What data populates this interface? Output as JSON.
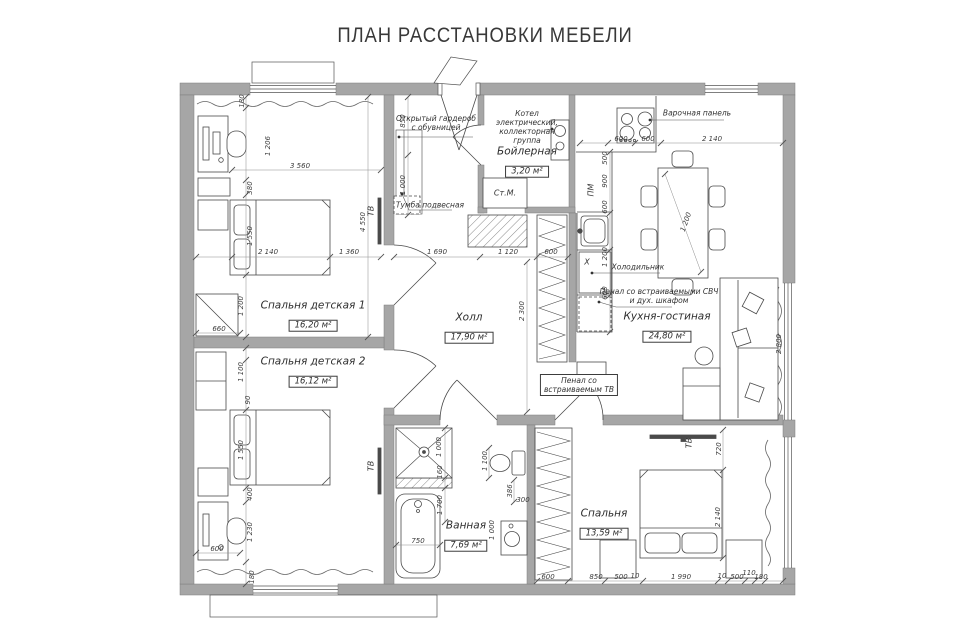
{
  "title": "ПЛАН РАССТАНОВКИ МЕБЕЛИ",
  "colors": {
    "wall_fill": "#a6a6a6",
    "wall_edge": "#7d7d7d",
    "line": "#4a4a4a",
    "dim_line": "#777777",
    "text": "#333333",
    "background": "#ffffff"
  },
  "rooms": [
    {
      "name": "Спальня детская 1",
      "area": "16,20 м²",
      "x": 313,
      "y": 316
    },
    {
      "name": "Спальня детская 2",
      "area": "16,12 м²",
      "x": 313,
      "y": 372
    },
    {
      "name": "Холл",
      "area": "17,90 м²",
      "x": 469,
      "y": 328
    },
    {
      "name": "Кухня-гостиная",
      "area": "24,80 м²",
      "x": 667,
      "y": 327
    },
    {
      "name": "Бойлерная",
      "area": "3,20 м²",
      "x": 527,
      "y": 162
    },
    {
      "name": "Ванная",
      "area": "7,69 м²",
      "x": 466,
      "y": 536
    },
    {
      "name": "Спальня",
      "area": "13,59 м²",
      "x": 604,
      "y": 524
    }
  ],
  "annotations": [
    {
      "text": "Открытый гардероб\nс обувницей",
      "x": 436,
      "y": 123
    },
    {
      "text": "Тумба подвесная",
      "x": 430,
      "y": 205
    },
    {
      "text": "Котел\nэлектрический,\nколлекторная\nгруппа",
      "x": 527,
      "y": 127
    },
    {
      "text": "Варочная панель",
      "x": 697,
      "y": 113
    },
    {
      "text": "Холодильник",
      "x": 638,
      "y": 267
    },
    {
      "text": "Пенал со встраиваемыми СВЧ\nи дух. шкафом",
      "x": 659,
      "y": 296
    },
    {
      "text": "Пенал со\nвстраиваемым ТВ",
      "x": 579,
      "y": 385,
      "boxed": true
    }
  ],
  "small_labels": [
    {
      "text": "ТВ",
      "x": 371,
      "y": 211,
      "rot": true
    },
    {
      "text": "ТВ",
      "x": 371,
      "y": 466,
      "rot": true
    },
    {
      "text": "ТВ",
      "x": 689,
      "y": 443,
      "rot": true
    },
    {
      "text": "ПМ",
      "x": 591,
      "y": 190,
      "rot": true
    },
    {
      "text": "X",
      "x": 587,
      "y": 262
    },
    {
      "text": "Ст.М.",
      "x": 505,
      "y": 193
    }
  ],
  "dimensions": [
    {
      "text": "180",
      "x": 242,
      "y": 101,
      "rot": true
    },
    {
      "text": "1 206",
      "x": 268,
      "y": 146,
      "rot": true
    },
    {
      "text": "380",
      "x": 250,
      "y": 188,
      "rot": true
    },
    {
      "text": "1 550",
      "x": 250,
      "y": 236,
      "rot": true
    },
    {
      "text": "3 560",
      "x": 300,
      "y": 166
    },
    {
      "text": "2 140",
      "x": 268,
      "y": 252
    },
    {
      "text": "1 360",
      "x": 349,
      "y": 252
    },
    {
      "text": "4 550",
      "x": 363,
      "y": 222,
      "rot": true
    },
    {
      "text": "660",
      "x": 219,
      "y": 329
    },
    {
      "text": "1 200",
      "x": 241,
      "y": 306,
      "rot": true
    },
    {
      "text": "1 100",
      "x": 241,
      "y": 372,
      "rot": true
    },
    {
      "text": "90",
      "x": 248,
      "y": 400,
      "rot": true
    },
    {
      "text": "1 550",
      "x": 241,
      "y": 450,
      "rot": true
    },
    {
      "text": "400",
      "x": 250,
      "y": 494,
      "rot": true
    },
    {
      "text": "1 230",
      "x": 250,
      "y": 532,
      "rot": true
    },
    {
      "text": "600",
      "x": 217,
      "y": 549
    },
    {
      "text": "180",
      "x": 252,
      "y": 577,
      "rot": true
    },
    {
      "text": "850",
      "x": 403,
      "y": 121,
      "rot": true
    },
    {
      "text": "1 000",
      "x": 403,
      "y": 185,
      "rot": true
    },
    {
      "text": "1 690",
      "x": 437,
      "y": 252
    },
    {
      "text": "1 120",
      "x": 508,
      "y": 252
    },
    {
      "text": "600",
      "x": 551,
      "y": 252
    },
    {
      "text": "2 300",
      "x": 522,
      "y": 311,
      "rot": true
    },
    {
      "text": "600",
      "x": 621,
      "y": 139
    },
    {
      "text": "600",
      "x": 648,
      "y": 139
    },
    {
      "text": "2 140",
      "x": 712,
      "y": 139
    },
    {
      "text": "500",
      "x": 605,
      "y": 158,
      "rot": true
    },
    {
      "text": "900",
      "x": 605,
      "y": 181,
      "rot": true
    },
    {
      "text": "600",
      "x": 605,
      "y": 207,
      "rot": true
    },
    {
      "text": "1 200",
      "x": 605,
      "y": 257,
      "rot": true
    },
    {
      "text": "600",
      "x": 605,
      "y": 293,
      "rot": true
    },
    {
      "text": "1 200",
      "x": 686,
      "y": 222,
      "deg": -70
    },
    {
      "text": "2 800",
      "x": 779,
      "y": 344,
      "rot": true
    },
    {
      "text": "720",
      "x": 719,
      "y": 449,
      "rot": true
    },
    {
      "text": "2 140",
      "x": 718,
      "y": 517,
      "rot": true
    },
    {
      "text": "1 000",
      "x": 439,
      "y": 447,
      "rot": true
    },
    {
      "text": "160",
      "x": 440,
      "y": 472,
      "rot": true
    },
    {
      "text": "1 700",
      "x": 440,
      "y": 505,
      "rot": true
    },
    {
      "text": "1 100",
      "x": 485,
      "y": 461,
      "rot": true
    },
    {
      "text": "386",
      "x": 510,
      "y": 491,
      "rot": true
    },
    {
      "text": "300",
      "x": 523,
      "y": 500
    },
    {
      "text": "750",
      "x": 418,
      "y": 541
    },
    {
      "text": "1 000",
      "x": 492,
      "y": 530,
      "rot": true
    },
    {
      "text": "600",
      "x": 548,
      "y": 577
    },
    {
      "text": "850",
      "x": 596,
      "y": 577
    },
    {
      "text": "500",
      "x": 621,
      "y": 577
    },
    {
      "text": "10",
      "x": 635,
      "y": 576
    },
    {
      "text": "1 990",
      "x": 681,
      "y": 577
    },
    {
      "text": "10",
      "x": 722,
      "y": 576
    },
    {
      "text": "500",
      "x": 737,
      "y": 577
    },
    {
      "text": "110",
      "x": 749,
      "y": 573
    },
    {
      "text": "180",
      "x": 761,
      "y": 577
    }
  ]
}
